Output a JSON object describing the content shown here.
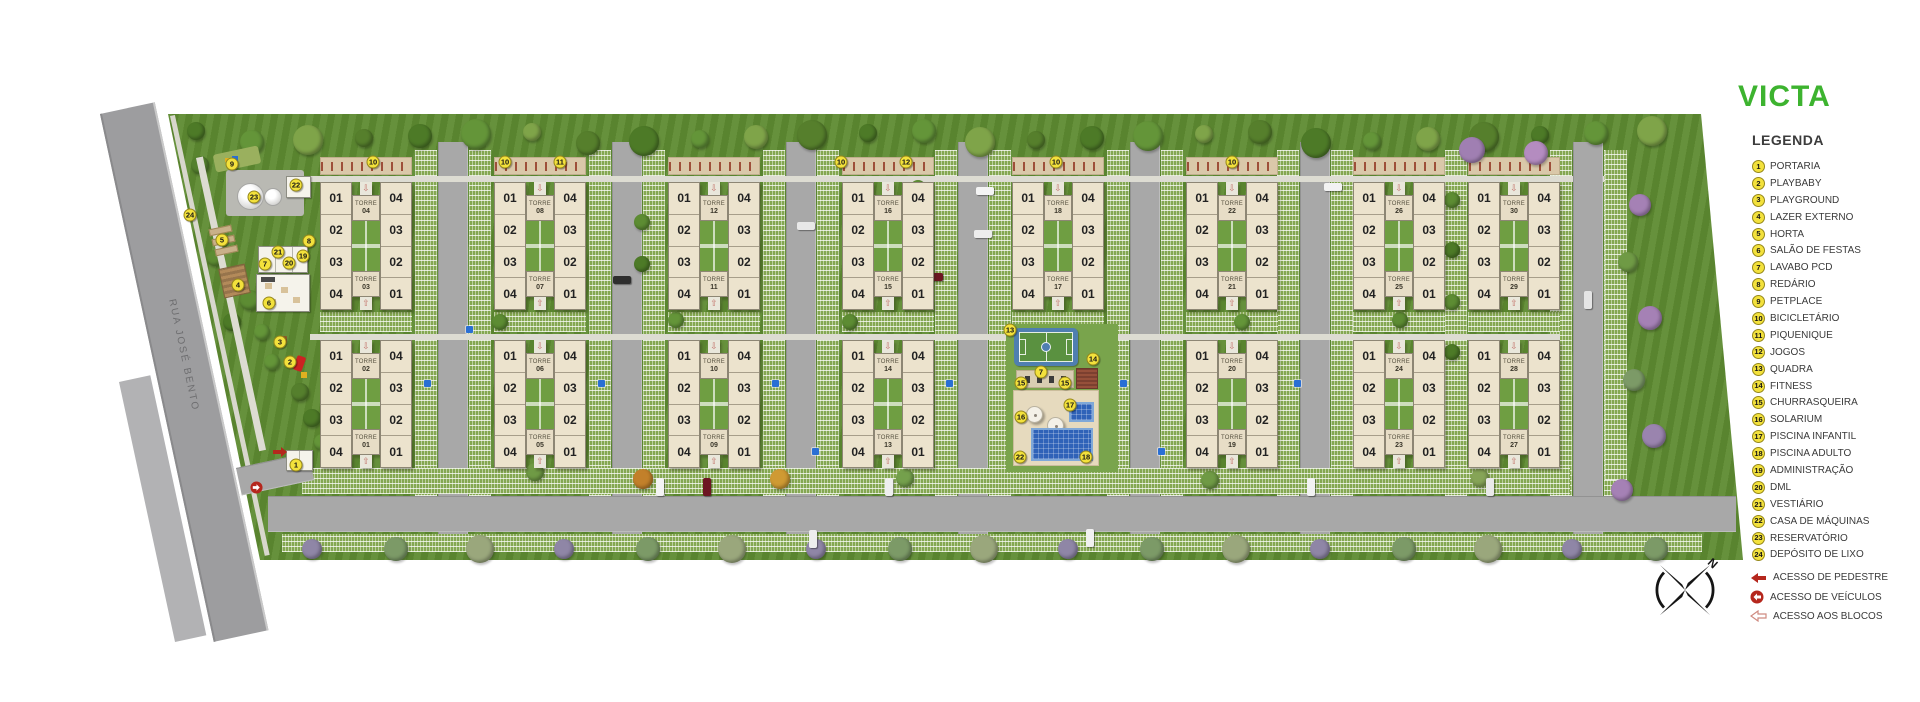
{
  "brand": {
    "logo_text": "VICTA",
    "logo_color": "#3db32f"
  },
  "legend": {
    "title": "LEGENDA",
    "items": [
      {
        "num": "1",
        "label": "PORTARIA"
      },
      {
        "num": "2",
        "label": "PLAYBABY"
      },
      {
        "num": "3",
        "label": "PLAYGROUND"
      },
      {
        "num": "4",
        "label": "LAZER EXTERNO"
      },
      {
        "num": "5",
        "label": "HORTA"
      },
      {
        "num": "6",
        "label": "SALÃO DE FESTAS"
      },
      {
        "num": "7",
        "label": "LAVABO PCD"
      },
      {
        "num": "8",
        "label": "REDÁRIO"
      },
      {
        "num": "9",
        "label": "PETPLACE"
      },
      {
        "num": "10",
        "label": "BICICLETÁRIO"
      },
      {
        "num": "11",
        "label": "PIQUENIQUE"
      },
      {
        "num": "12",
        "label": "JOGOS"
      },
      {
        "num": "13",
        "label": "QUADRA"
      },
      {
        "num": "14",
        "label": "FITNESS"
      },
      {
        "num": "15",
        "label": "CHURRASQUEIRA"
      },
      {
        "num": "16",
        "label": "SOLARIUM"
      },
      {
        "num": "17",
        "label": "PISCINA INFANTIL"
      },
      {
        "num": "18",
        "label": "PISCINA ADULTO"
      },
      {
        "num": "19",
        "label": "ADMINISTRAÇÃO"
      },
      {
        "num": "20",
        "label": "DML"
      },
      {
        "num": "21",
        "label": "VESTIÁRIO"
      },
      {
        "num": "22",
        "label": "CASA DE MÁQUINAS"
      },
      {
        "num": "23",
        "label": "RESERVATÓRIO"
      },
      {
        "num": "24",
        "label": "DEPÓSITO DE LIXO"
      }
    ],
    "access": [
      {
        "icon": "solid-arrow",
        "label": "ACESSO DE PEDESTRE"
      },
      {
        "icon": "circle-arrow",
        "label": "ACESSO DE VEÍCULOS"
      },
      {
        "icon": "outline-arrow",
        "label": "ACESSO AOS BLOCOS"
      }
    ]
  },
  "site": {
    "street_name": "RUA JOSÉ BENTO",
    "tower_word": "TORRE",
    "unit_labels": [
      "01",
      "02",
      "03",
      "04"
    ],
    "blocks": [
      {
        "col": 1,
        "row": "top",
        "top_tower": "04",
        "bottom_tower": "03"
      },
      {
        "col": 2,
        "row": "top",
        "top_tower": "08",
        "bottom_tower": "07"
      },
      {
        "col": 3,
        "row": "top",
        "top_tower": "12",
        "bottom_tower": "11"
      },
      {
        "col": 4,
        "row": "top",
        "top_tower": "16",
        "bottom_tower": "15"
      },
      {
        "col": 5,
        "row": "top",
        "top_tower": "18",
        "bottom_tower": "17"
      },
      {
        "col": 6,
        "row": "top",
        "top_tower": "22",
        "bottom_tower": "21"
      },
      {
        "col": 7,
        "row": "top",
        "top_tower": "26",
        "bottom_tower": "25"
      },
      {
        "col": 8,
        "row": "top",
        "top_tower": "30",
        "bottom_tower": "29"
      },
      {
        "col": 1,
        "row": "bottom",
        "top_tower": "02",
        "bottom_tower": "01"
      },
      {
        "col": 2,
        "row": "bottom",
        "top_tower": "06",
        "bottom_tower": "05"
      },
      {
        "col": 3,
        "row": "bottom",
        "top_tower": "10",
        "bottom_tower": "09"
      },
      {
        "col": 4,
        "row": "bottom",
        "top_tower": "14",
        "bottom_tower": "13"
      },
      {
        "col": 6,
        "row": "bottom",
        "top_tower": "20",
        "bottom_tower": "19"
      },
      {
        "col": 7,
        "row": "bottom",
        "top_tower": "24",
        "bottom_tower": "23"
      },
      {
        "col": 8,
        "row": "bottom",
        "top_tower": "28",
        "bottom_tower": "27"
      }
    ],
    "markers": [
      {
        "num": "10",
        "x": 373,
        "y": 162
      },
      {
        "num": "10",
        "x": 505,
        "y": 162
      },
      {
        "num": "11",
        "x": 560,
        "y": 162
      },
      {
        "num": "10",
        "x": 841,
        "y": 162
      },
      {
        "num": "12",
        "x": 906,
        "y": 162
      },
      {
        "num": "10",
        "x": 1056,
        "y": 162
      },
      {
        "num": "10",
        "x": 1232,
        "y": 162
      },
      {
        "num": "9",
        "x": 232,
        "y": 164
      },
      {
        "num": "23",
        "x": 254,
        "y": 197
      },
      {
        "num": "22",
        "x": 296,
        "y": 185
      },
      {
        "num": "24",
        "x": 190,
        "y": 215
      },
      {
        "num": "5",
        "x": 222,
        "y": 240
      },
      {
        "num": "8",
        "x": 309,
        "y": 241
      },
      {
        "num": "21",
        "x": 278,
        "y": 252
      },
      {
        "num": "19",
        "x": 303,
        "y": 256
      },
      {
        "num": "20",
        "x": 289,
        "y": 263
      },
      {
        "num": "7",
        "x": 265,
        "y": 264
      },
      {
        "num": "4",
        "x": 238,
        "y": 285
      },
      {
        "num": "6",
        "x": 269,
        "y": 303
      },
      {
        "num": "3",
        "x": 280,
        "y": 342
      },
      {
        "num": "2",
        "x": 290,
        "y": 362
      },
      {
        "num": "1",
        "x": 296,
        "y": 465
      },
      {
        "num": "13",
        "x": 1010,
        "y": 330
      },
      {
        "num": "14",
        "x": 1093,
        "y": 359
      },
      {
        "num": "7",
        "x": 1041,
        "y": 372
      },
      {
        "num": "15",
        "x": 1021,
        "y": 383
      },
      {
        "num": "15",
        "x": 1065,
        "y": 383
      },
      {
        "num": "17",
        "x": 1070,
        "y": 405
      },
      {
        "num": "16",
        "x": 1021,
        "y": 417
      },
      {
        "num": "22",
        "x": 1020,
        "y": 457
      },
      {
        "num": "18",
        "x": 1086,
        "y": 457
      }
    ]
  },
  "compass": {
    "label": "N"
  }
}
